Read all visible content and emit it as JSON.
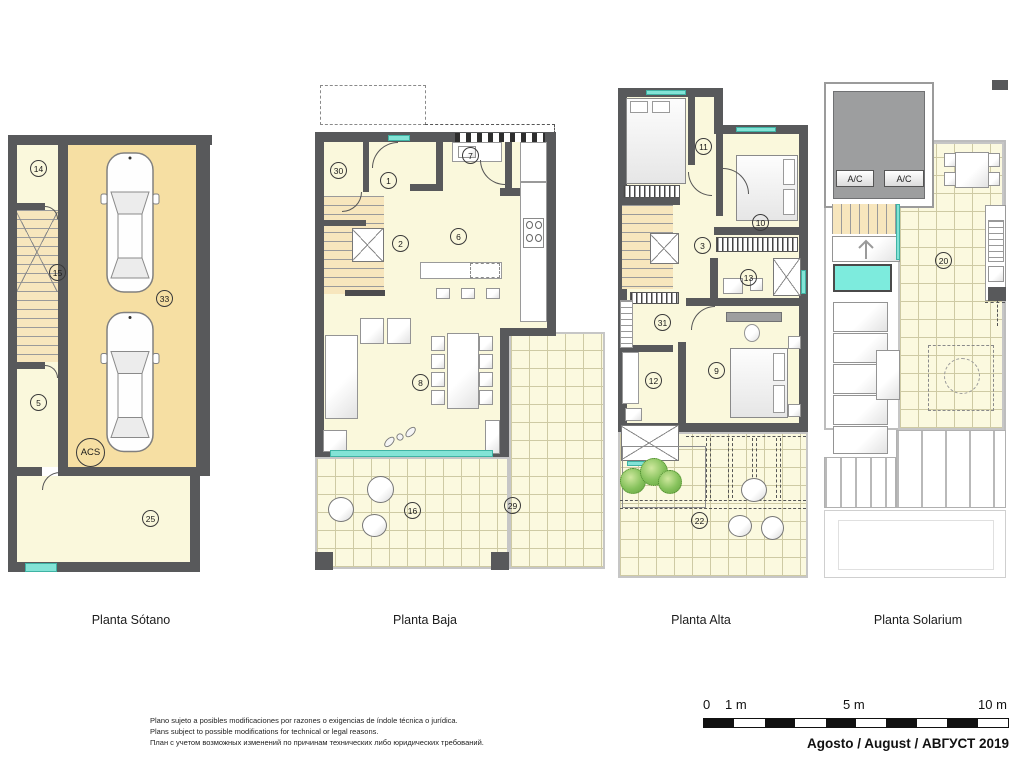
{
  "document": {
    "type": "floor-plan-sheet",
    "background": "#ffffff"
  },
  "colors": {
    "wall": "#58595b",
    "room_floor": "#faf8dc",
    "garage_floor": "#f6dfa3",
    "stair_floor": "#f7e6bd",
    "tile_line": "#cecaa4",
    "window_accent": "#83e3d6",
    "pool": "#7debdd",
    "roof_gray": "#9d9e9f",
    "plant_green": "#86c25c"
  },
  "plans": [
    {
      "label": "Planta Sótano",
      "rooms": [
        "14",
        "15",
        "33",
        "5",
        "25"
      ],
      "acs": "ACS"
    },
    {
      "label": "Planta Baja",
      "rooms": [
        "30",
        "1",
        "7",
        "2",
        "6",
        "8",
        "16",
        "29"
      ]
    },
    {
      "label": "Planta Alta",
      "rooms": [
        "11",
        "10",
        "3",
        "13",
        "31",
        "12",
        "9",
        "22"
      ]
    },
    {
      "label": "Planta Solarium",
      "rooms": [
        "20"
      ],
      "ac_units": [
        "A/C",
        "A/C"
      ]
    }
  ],
  "scale_bar": {
    "labels": [
      "0",
      "1 m",
      "5 m",
      "10 m"
    ]
  },
  "footer": {
    "date_line": "Agosto / August / АВГУСТ 2019",
    "disclaimer": [
      "Plano sujeto a posibles modificaciones por razones o exigencias de índole técnica o jurídica.",
      "Plans subject to possible modifications for technical or legal reasons.",
      "План с учетом возможных изменений по причинам технических либо юридических требований."
    ]
  }
}
